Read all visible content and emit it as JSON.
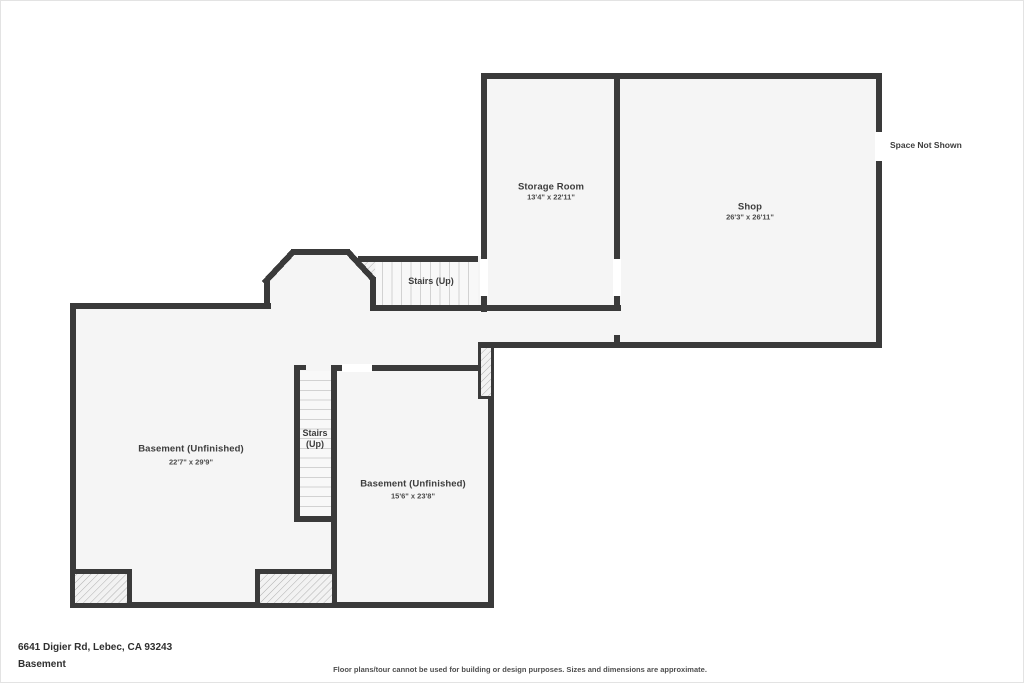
{
  "page": {
    "address": "6641 Digier Rd, Lebec, CA 93243",
    "floor_name": "Basement",
    "disclaimer": "Floor plans/tour cannot be used for building or design purposes. Sizes and dimensions are approximate."
  },
  "rooms": {
    "storage": {
      "name": "Storage Room",
      "dims": "13'4\" x 22'11\""
    },
    "shop": {
      "name": "Shop",
      "dims": "26'3\" x 26'11\""
    },
    "basement_left": {
      "name": "Basement (Unfinished)",
      "dims": "22'7\" x 29'9\""
    },
    "basement_right": {
      "name": "Basement (Unfinished)",
      "dims": "15'6\" x 23'8\""
    },
    "stairs_upper": {
      "name": "Stairs (Up)"
    },
    "stairs_mid": {
      "line1": "Stairs",
      "line2": "(Up)"
    }
  },
  "annotations": {
    "space_not_shown": "Space Not Shown"
  },
  "colors": {
    "wall": "#3a3a3a",
    "room_fill": "#f5f5f5",
    "stair_fill": "#f8f8f8",
    "tread_line": "#d2d2d2",
    "hatch_line": "#b0b0b0",
    "text": "#3d3d3d"
  }
}
